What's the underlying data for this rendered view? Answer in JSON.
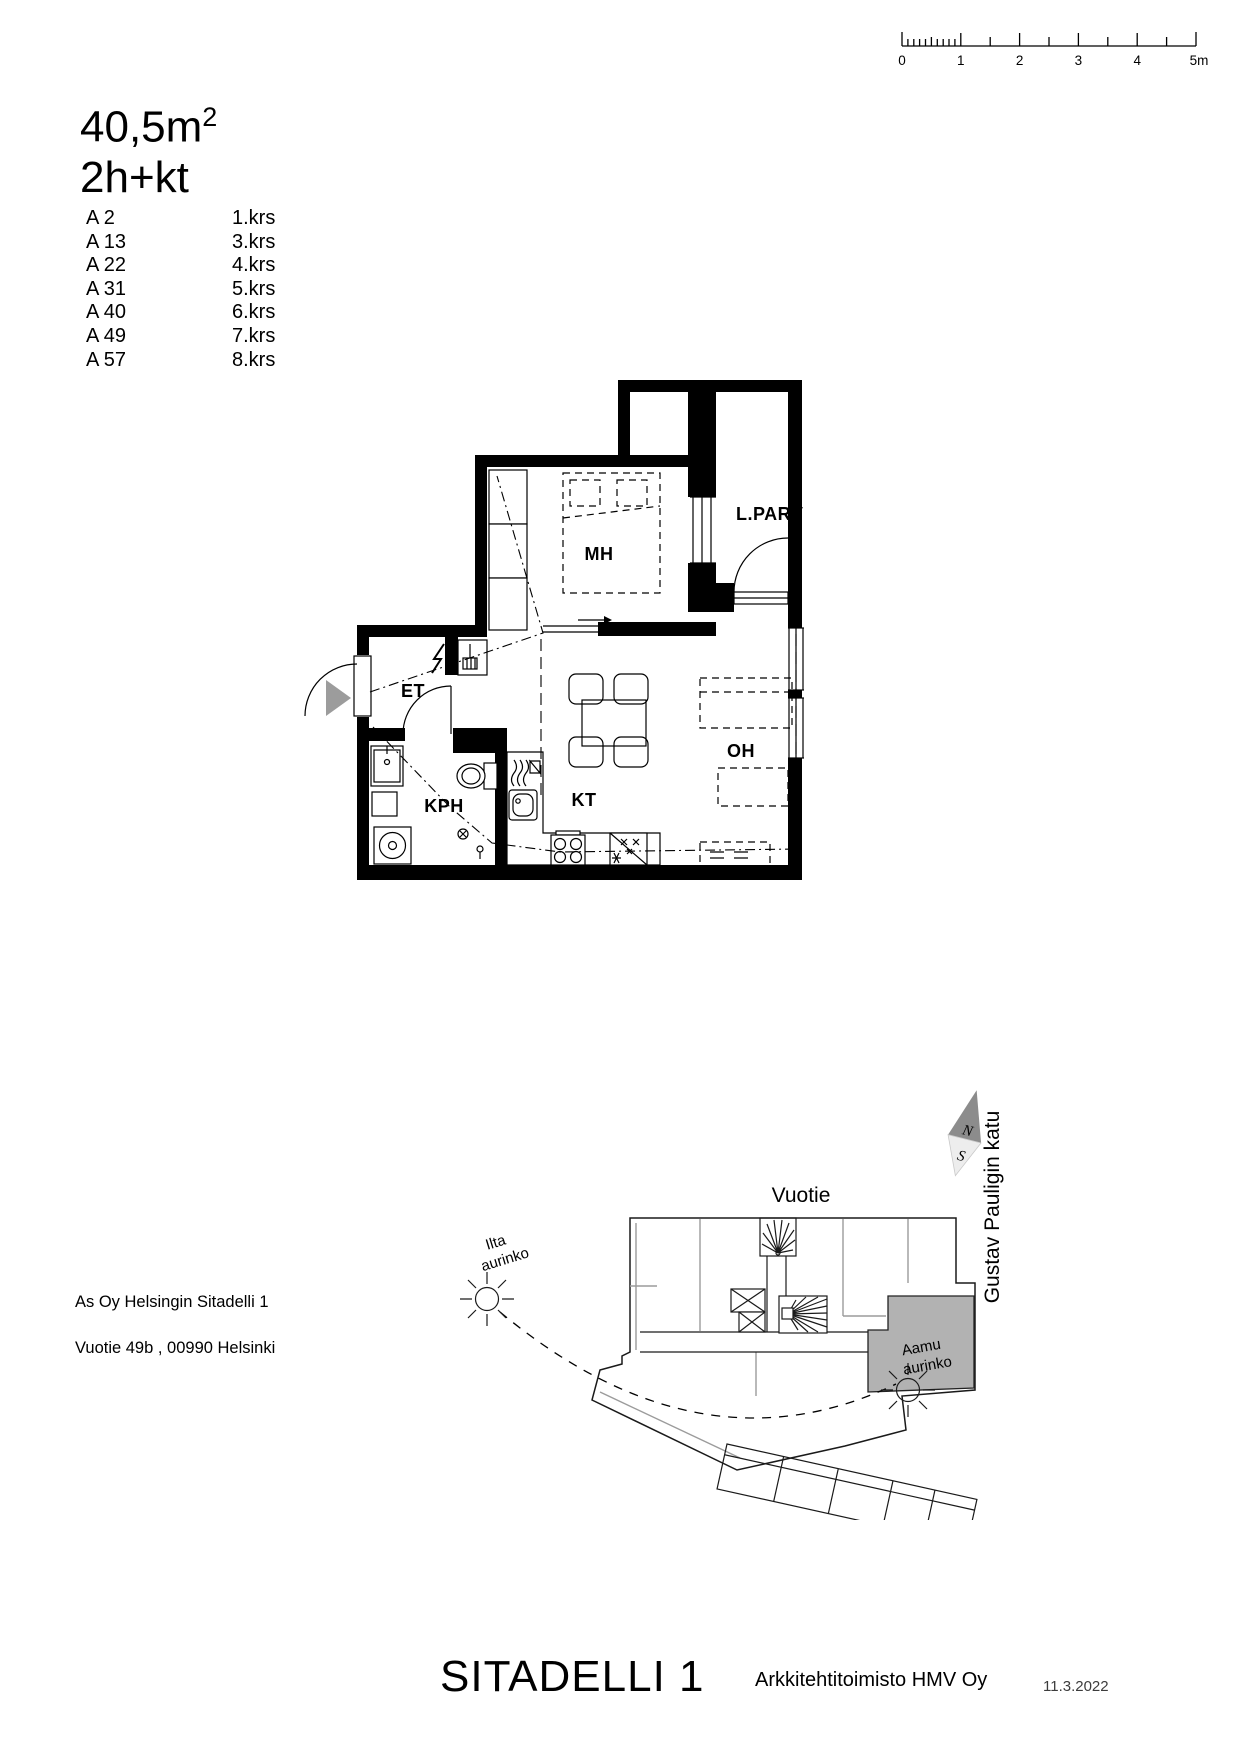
{
  "header": {
    "area_value": "40,5m",
    "area_exponent": "2",
    "layout": "2h+kt"
  },
  "apartments": [
    {
      "unit": "A 2",
      "floor": "1.krs"
    },
    {
      "unit": "A 13",
      "floor": "3.krs"
    },
    {
      "unit": "A 22",
      "floor": "4.krs"
    },
    {
      "unit": "A 31",
      "floor": "5.krs"
    },
    {
      "unit": "A 40",
      "floor": "6.krs"
    },
    {
      "unit": "A 49",
      "floor": "7.krs"
    },
    {
      "unit": "A 57",
      "floor": "8.krs"
    }
  ],
  "scale_bar": {
    "unit_labels": [
      "0",
      "1",
      "2",
      "3",
      "4",
      "5m"
    ]
  },
  "floor_plan": {
    "rooms": {
      "bedroom": "MH",
      "balcony": "L.PARV",
      "entry": "ET",
      "bathroom": "KPH",
      "kitchen": "KT",
      "living_room": "OH"
    }
  },
  "site_plan": {
    "street_top": "Vuotie",
    "street_right": "Gustav Pauligin katu",
    "evening_sun_line1": "Ilta",
    "evening_sun_line2": "aurinko",
    "morning_sun_line1": "Aamu",
    "morning_sun_line2": "aurinko",
    "compass_north": "N",
    "compass_south": "S",
    "highlight_color": "#b2b2b2"
  },
  "address": {
    "line1": "As Oy Helsingin Sitadelli 1",
    "line2": "Vuotie 49b , 00990 Helsinki"
  },
  "footer": {
    "project": "SITADELLI 1",
    "architect": "Arkkitehtitoimisto HMV Oy",
    "date": "11.3.2022"
  }
}
